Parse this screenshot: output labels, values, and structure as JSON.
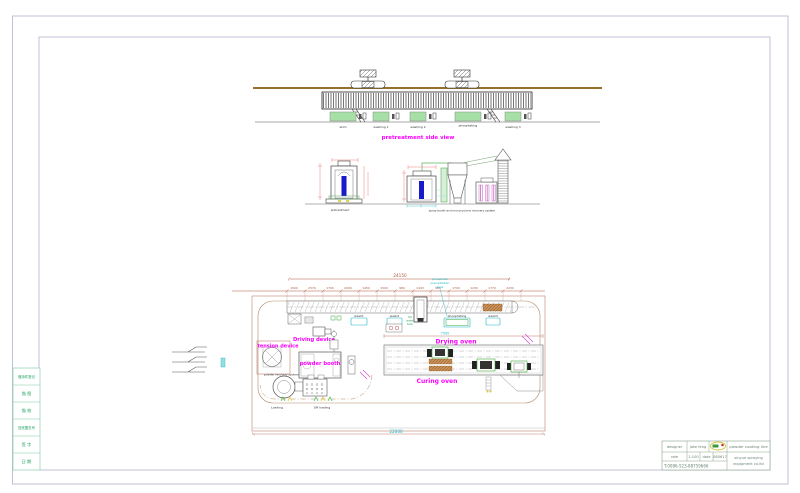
{
  "drawing": {
    "side_view": {
      "caption": "pretreatment side view",
      "tanks": [
        "skim",
        "washing 1",
        "washing 2",
        "phosphating",
        "washing 3"
      ]
    },
    "elevations": {
      "pretreatment_caption": "pretreatment",
      "booth_caption": "spray booth and monocyclone recovery system"
    },
    "plan": {
      "overall_dim": "24150",
      "bottom_dim": "22000",
      "oven_dim": "7500",
      "dims": [
        "1500",
        "2570",
        "1700",
        "2000",
        "1450",
        "1500",
        "980",
        "1443",
        "980",
        "1700",
        "1230",
        "1770",
        "2230"
      ],
      "tank_labels": [
        "wash1",
        "wash2",
        "phosphating",
        "wash3"
      ],
      "phosphate_note": {
        "l1": "phosphate",
        "l2": "precipitation",
        "l3": "tank"
      },
      "hot_water_note": {
        "l1": "hot",
        "l2": "water",
        "l3": "tank"
      },
      "driving_device": "Driving device",
      "tension_device": "tension device",
      "powder_booth": "powder booth",
      "powder_recovery": "powder recovery system",
      "drying_oven": "Drying oven",
      "curing_oven": "Curing oven",
      "loading": "Loading",
      "off_loading": "Off loading"
    }
  },
  "title_block": {
    "designer_label": "designer",
    "designer_value": "jake feng",
    "rate_label": "rate",
    "rate_value": "1:100",
    "date_label": "date",
    "date_value": "080617",
    "phone": "T:0086-523-88759666",
    "product": "powder coating line",
    "company_line1": "xinyue spraying",
    "company_line2": "equipment co.ltd"
  },
  "left_table": {
    "rows": [
      "借用件登记",
      "描 图",
      "描 校",
      "旧底图总号",
      "签 字",
      "日 期"
    ]
  },
  "colors": {
    "magenta": "#ff00ff",
    "cyan": "#19b8c8",
    "dim_red": "#b0543f",
    "beam_brown": "#96702a",
    "tank_green": "#a6e0a6",
    "booth_blue": "#1a1acd",
    "frame_gray": "#b8bcd0",
    "table_green": "#1da35c"
  }
}
